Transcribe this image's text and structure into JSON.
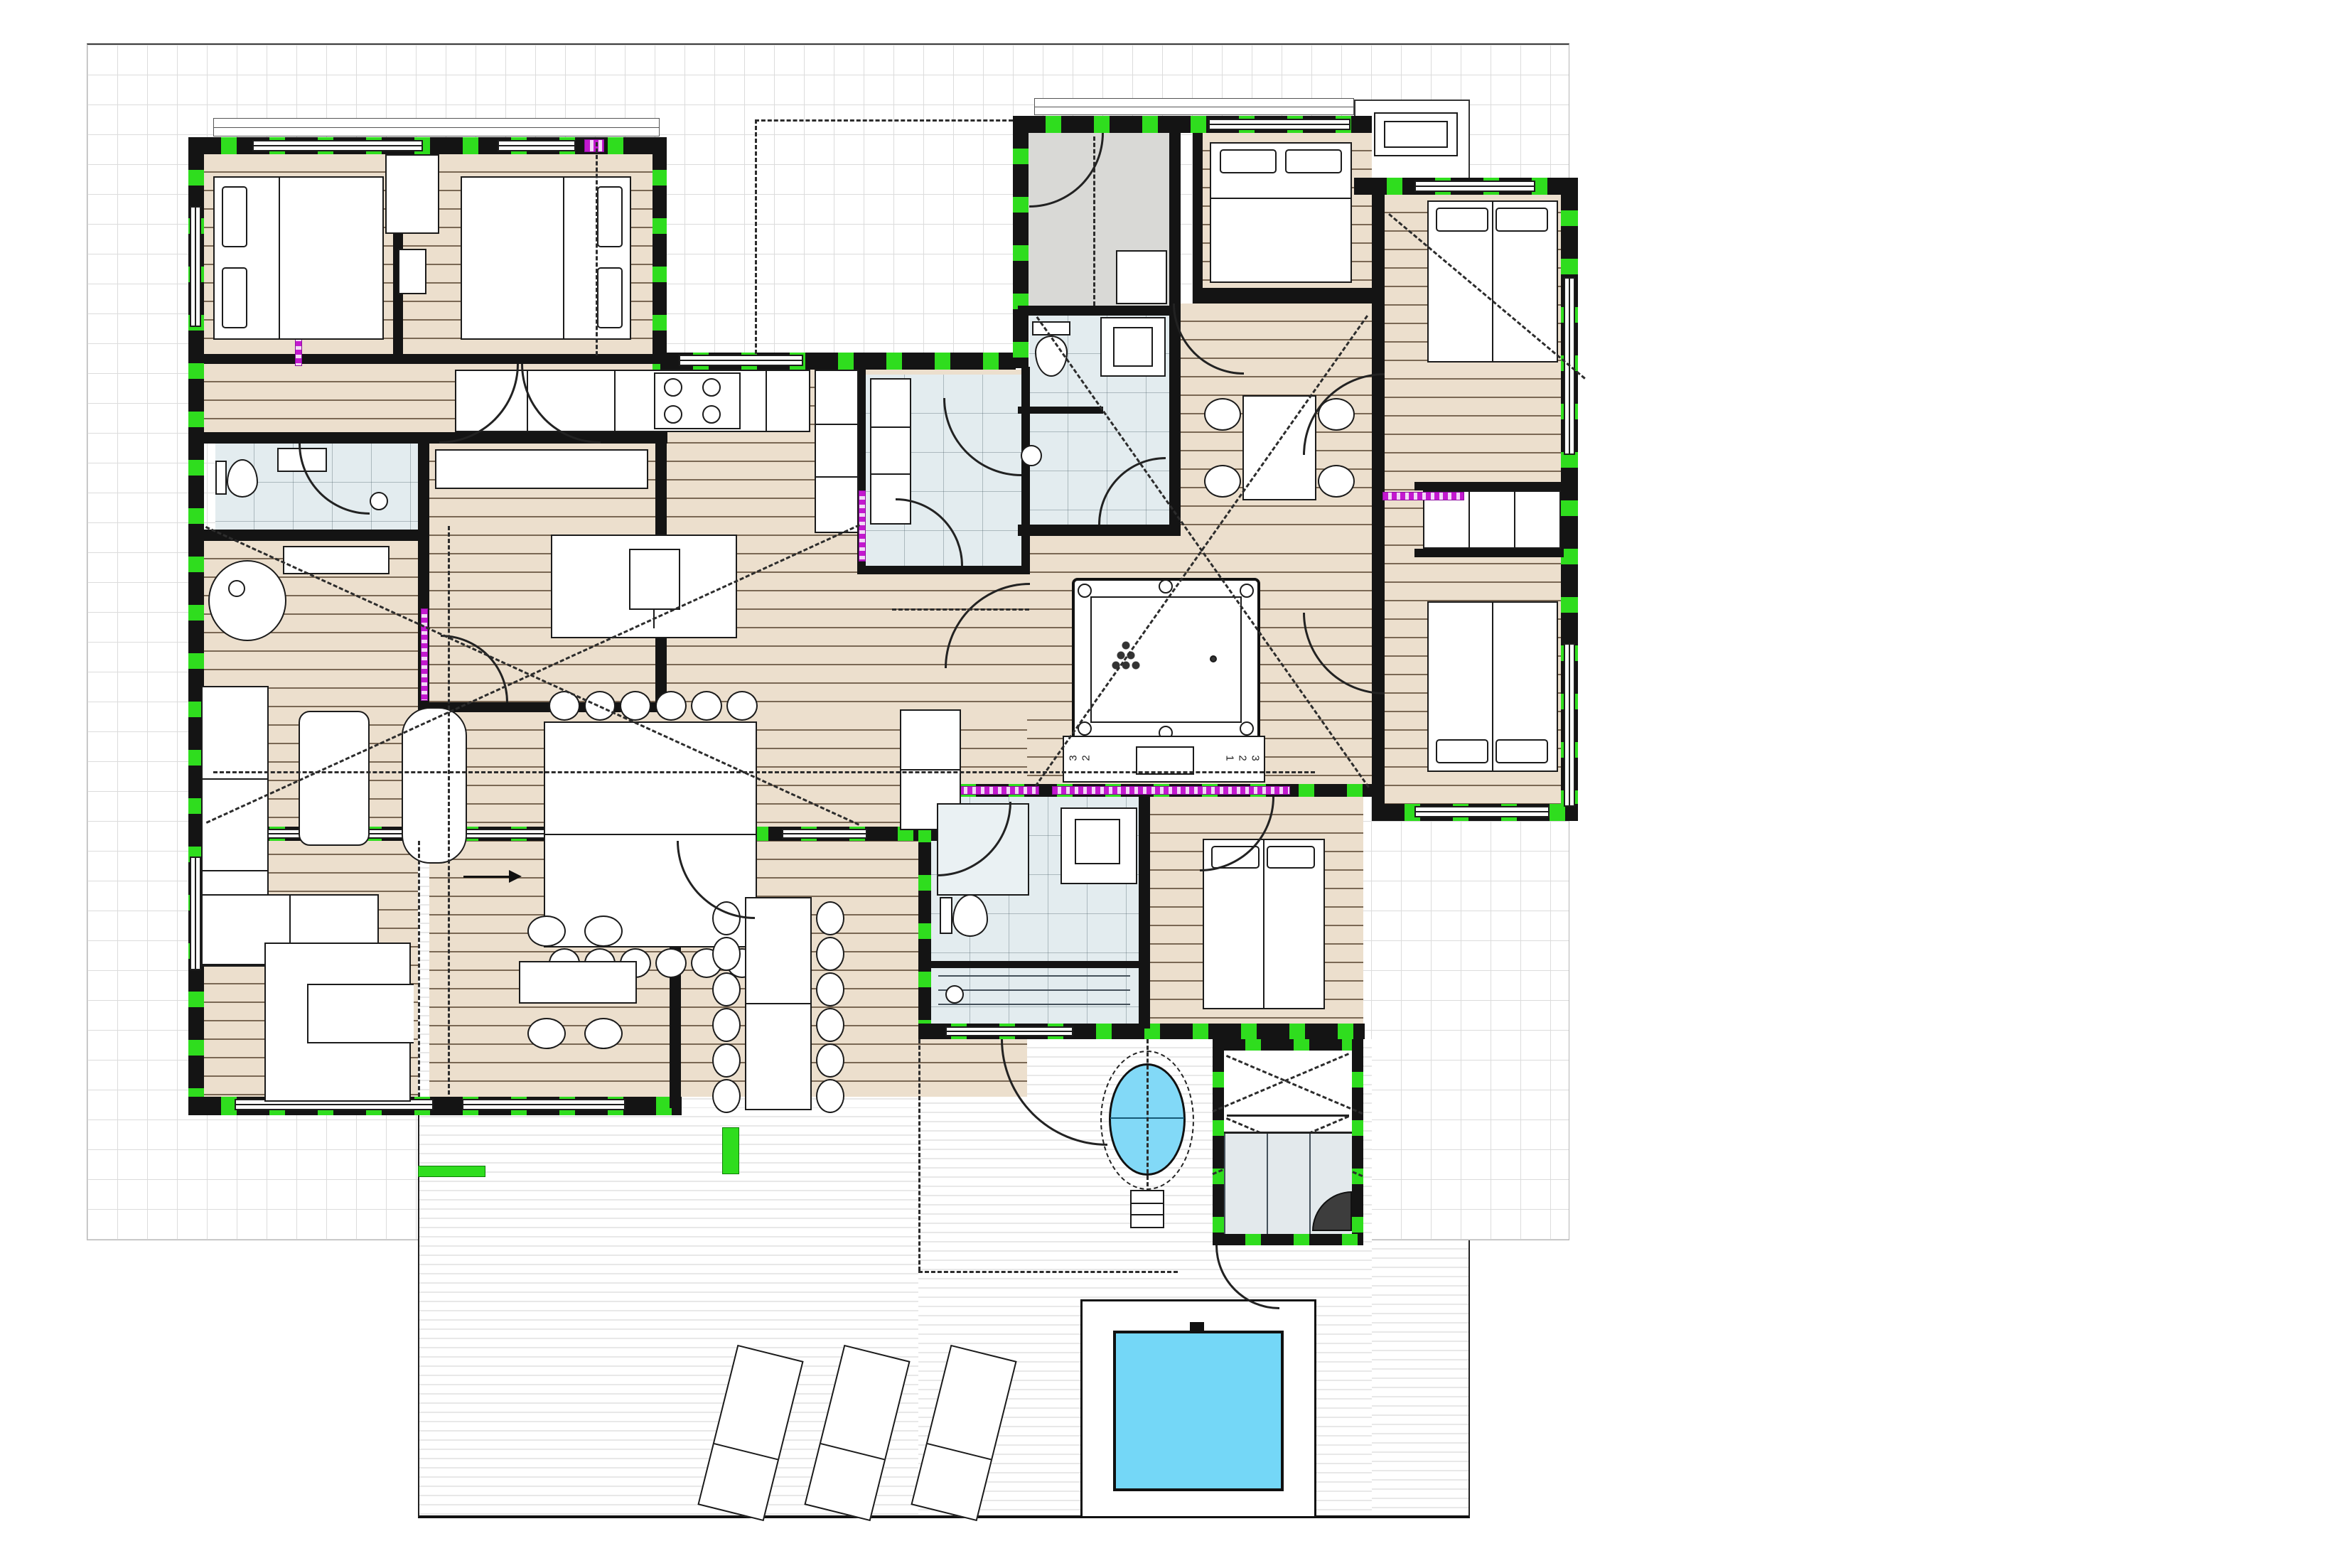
{
  "document": {
    "type": "architectural-floor-plan",
    "view": "single-storey holiday house, ground floor with pool deck",
    "units_shown": false
  },
  "palette": {
    "wall": "#141414",
    "insulation_green": "#2fdd1e",
    "sliding_track_magenta": "#c318cf",
    "wood_floor": "#ecdfcd",
    "tile_floor": "#e3ecef",
    "gray_floor": "#d9d9d6",
    "pool_water": "#74d7f7",
    "hot_tub_water": "#82d9f7",
    "grid_line": "#dcdcdc"
  },
  "site": {
    "grid_paper": true,
    "deck_areas": 4,
    "pool": 1,
    "hot_tub": 1,
    "outdoor_sauna": 1,
    "sun_loungers": 3
  },
  "rooms": [
    {
      "name": "bedroom-northwest-1",
      "floor": "wood",
      "furniture": "double bed"
    },
    {
      "name": "bedroom-northwest-2",
      "floor": "wood",
      "furniture": "double bed"
    },
    {
      "name": "hallway-northwest",
      "floor": "wood"
    },
    {
      "name": "bathroom-west",
      "floor": "tile",
      "fixtures": "toilet, sink, shower"
    },
    {
      "name": "walk-in-closet",
      "floor": "wood"
    },
    {
      "name": "kitchen",
      "floor": "wood",
      "fixtures": "counter with cooktop, island with sink, tall units"
    },
    {
      "name": "living-room",
      "floor": "wood",
      "furniture": "corner sofa, armchair, coffee table, wood stove, dining table 12 seats"
    },
    {
      "name": "mudroom-entry",
      "floor": "tile"
    },
    {
      "name": "laundry-storage",
      "floor": "gray"
    },
    {
      "name": "bedroom-north-center",
      "floor": "wood",
      "furniture": "double bed"
    },
    {
      "name": "wc-center",
      "floor": "tile",
      "fixtures": "toilet, washbasin, basin"
    },
    {
      "name": "games-hall",
      "floor": "wood",
      "furniture": "pool table, media unit, breakfast table 4 chairs"
    },
    {
      "name": "bedroom-northeast-upper",
      "floor": "wood",
      "furniture": "double bed"
    },
    {
      "name": "bedroom-northeast-lower",
      "floor": "wood",
      "furniture": "double bed"
    },
    {
      "name": "bathroom-south",
      "floor": "tile",
      "fixtures": "shower, washbasin, toilet"
    },
    {
      "name": "steam-room-south",
      "floor": "tile"
    },
    {
      "name": "bedroom-south",
      "floor": "wood",
      "furniture": "double bed"
    },
    {
      "name": "carport-terrace",
      "floor": "deck",
      "furniture": "outdoor kitchen U-counter, table with 4 chairs"
    },
    {
      "name": "walkway-terrace",
      "floor": "deck",
      "furniture": "outdoor dining table 12 chairs"
    },
    {
      "name": "pool-deck",
      "floor": "deck",
      "furniture": "3 loungers, pool"
    }
  ],
  "media_unit": {
    "drawer_labels_left": [
      "3",
      "2"
    ],
    "drawer_labels_right": [
      "1",
      "2",
      "3"
    ]
  }
}
